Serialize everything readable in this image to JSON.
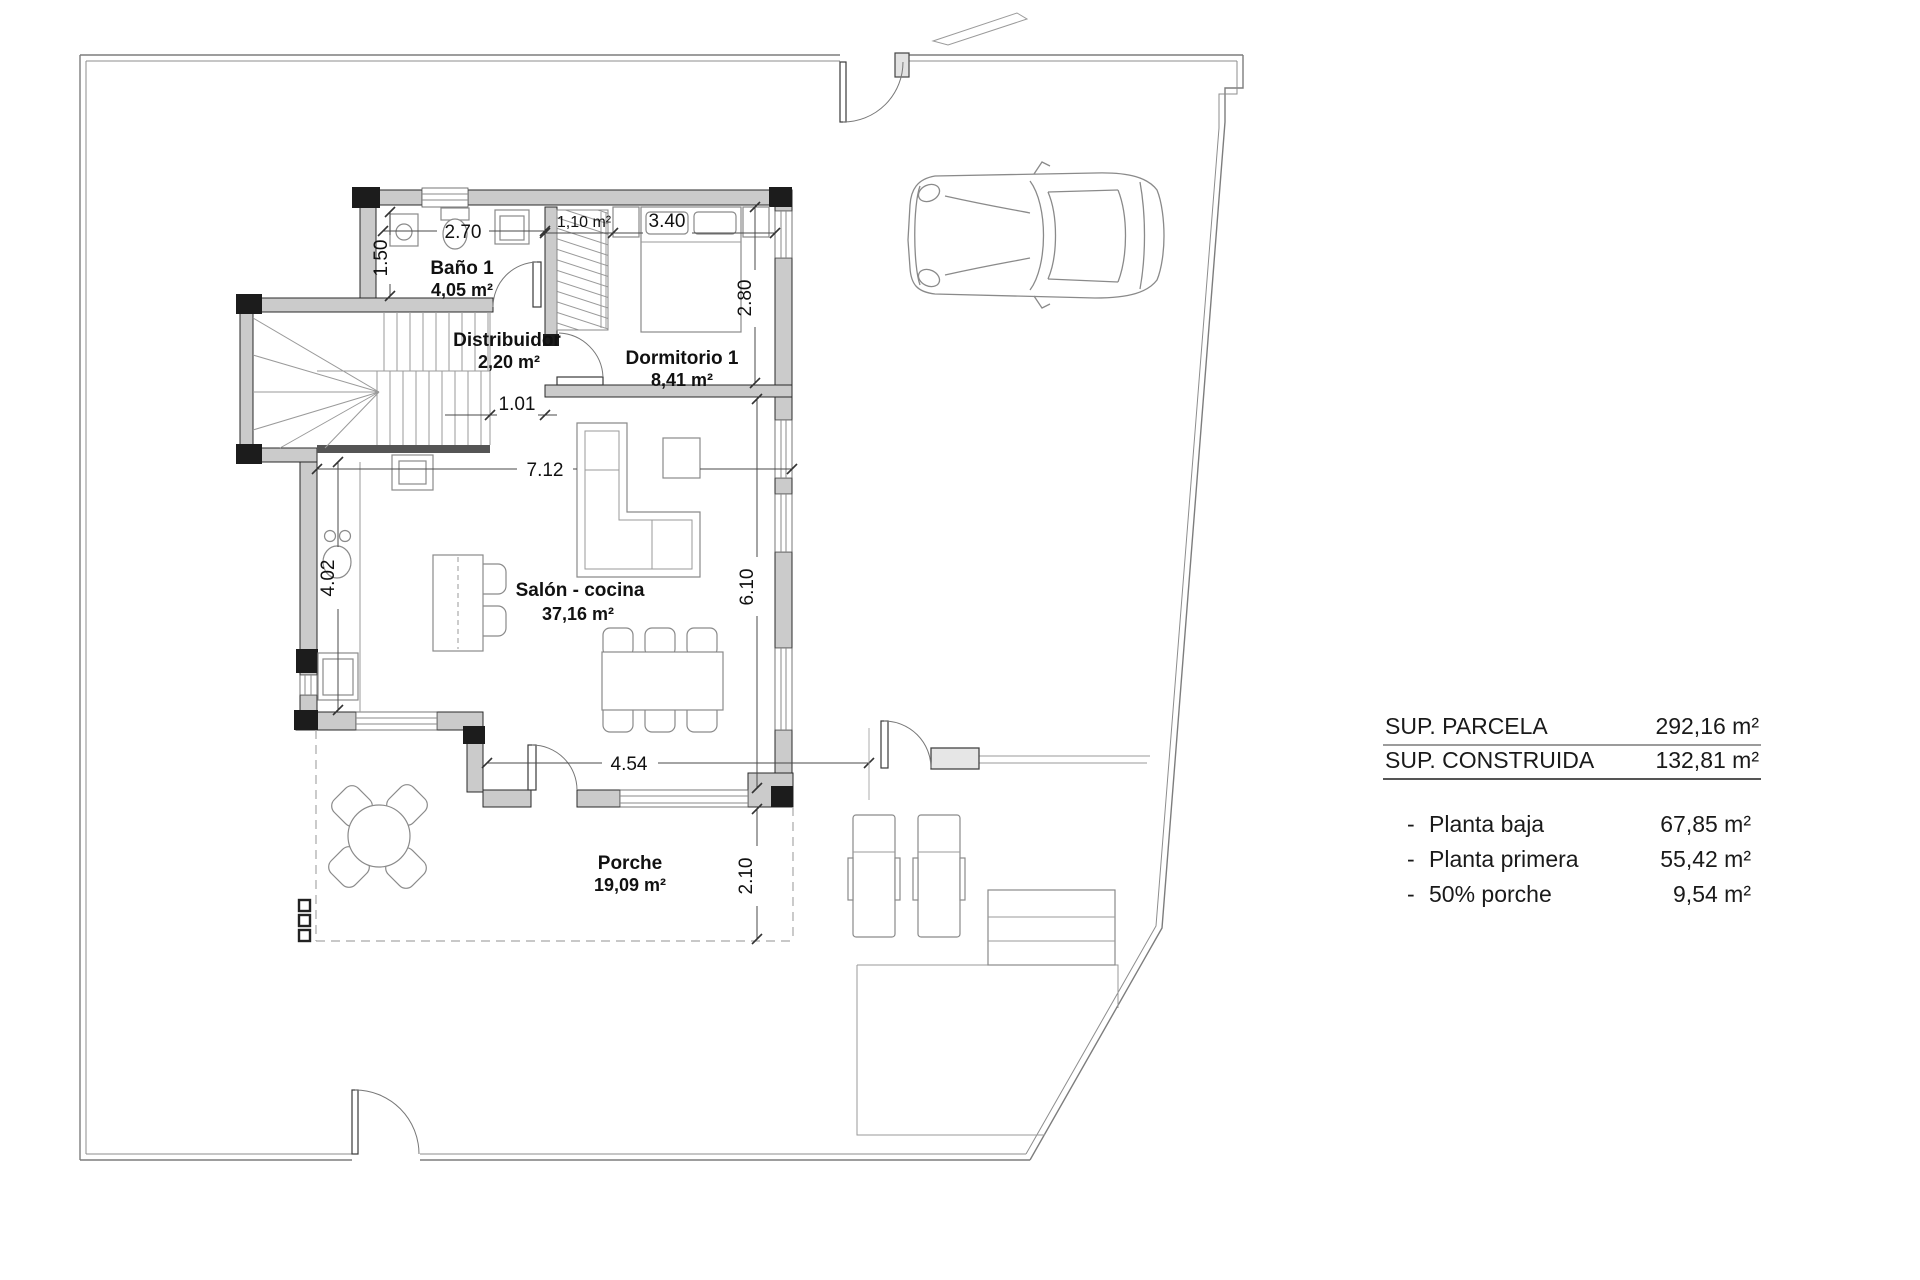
{
  "plan": {
    "rooms": {
      "bano": {
        "name": "Baño 1",
        "area": "4,05 m²"
      },
      "distribuidor": {
        "name": "Distribuidor",
        "area": "2,20 m²"
      },
      "armario": {
        "area": "1,10 m²"
      },
      "dormitorio": {
        "name": "Dormitorio 1",
        "area": "8,41 m²"
      },
      "salon": {
        "name": "Salón - cocina",
        "area": "37,16 m²"
      },
      "porche": {
        "name": "Porche",
        "area": "19,09 m²"
      }
    },
    "dimensions": {
      "bath_width": "2.70",
      "bath_depth": "1.50",
      "bedroom_width": "3.40",
      "bedroom_depth": "2.80",
      "hall_opening": "1.01",
      "living_width": "7.12",
      "living_left_depth": "4.02",
      "living_right_depth": "6.10",
      "porch_width": "4.54",
      "porch_depth": "2.10"
    }
  },
  "summary": {
    "totals": [
      {
        "label": "SUP. PARCELA",
        "value": "292,16 m²"
      },
      {
        "label": "SUP. CONSTRUIDA",
        "value": "132,81 m²"
      }
    ],
    "breakdown": [
      {
        "bullet": "-",
        "label": "Planta baja",
        "value": "67,85 m²"
      },
      {
        "bullet": "-",
        "label": "Planta primera",
        "value": "55,42 m²"
      },
      {
        "bullet": "-",
        "label": "50% porche",
        "value": "9,54 m²"
      }
    ]
  }
}
